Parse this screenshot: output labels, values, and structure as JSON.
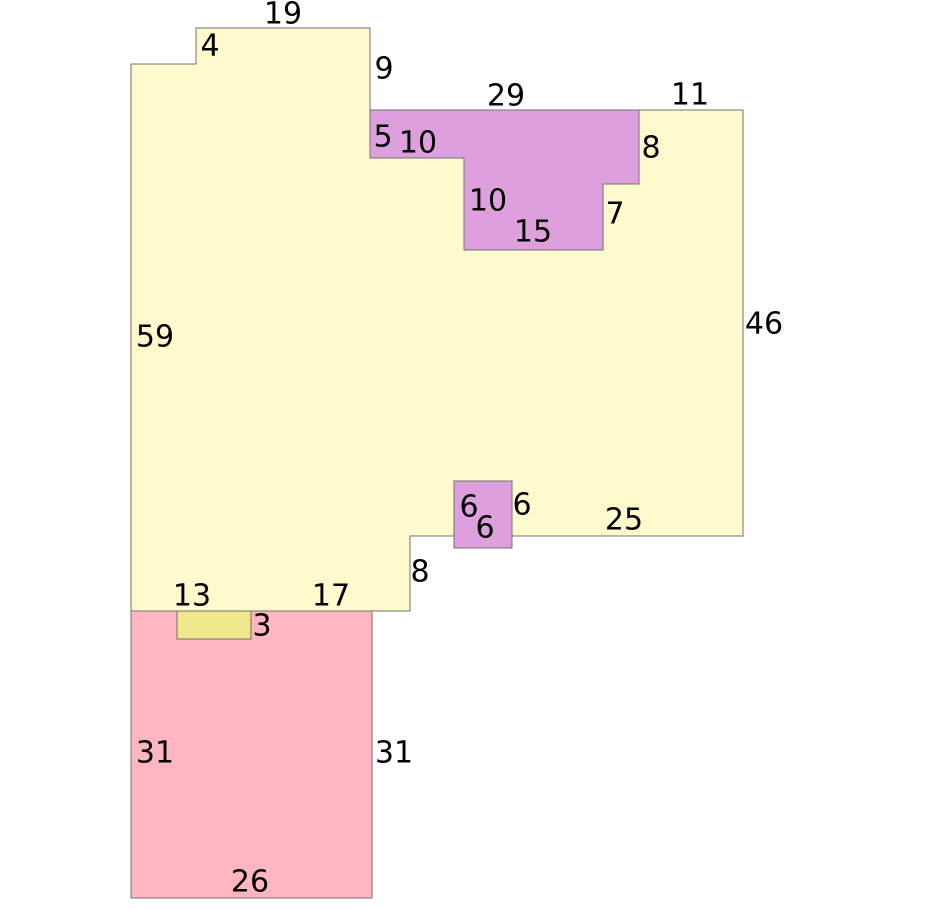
{
  "figure": {
    "background": "#ffffff",
    "stroke_color": "#707070",
    "label_color": "#000000",
    "shapes": [
      {
        "name": "main-yellow-polygon",
        "fill": "#FFFACD",
        "points": [
          [
            131,
            64
          ],
          [
            196,
            64
          ],
          [
            196,
            28
          ],
          [
            370,
            28
          ],
          [
            370,
            110
          ],
          [
            743,
            110
          ],
          [
            743,
            536
          ],
          [
            410,
            536
          ],
          [
            410,
            611
          ],
          [
            131,
            611
          ]
        ]
      },
      {
        "name": "pink-rectangle",
        "fill": "#FFB6C1",
        "points": [
          [
            131,
            611
          ],
          [
            372,
            611
          ],
          [
            372,
            898
          ],
          [
            131,
            898
          ]
        ]
      },
      {
        "name": "khaki-rectangle",
        "fill": "#F0E68C",
        "points": [
          [
            177,
            611
          ],
          [
            251,
            611
          ],
          [
            251,
            639
          ],
          [
            177,
            639
          ]
        ]
      },
      {
        "name": "purple-t-polygon",
        "fill": "#DDA0DD",
        "points": [
          [
            370,
            110
          ],
          [
            639,
            110
          ],
          [
            639,
            184
          ],
          [
            603,
            184
          ],
          [
            603,
            250
          ],
          [
            464,
            250
          ],
          [
            464,
            158
          ],
          [
            370,
            158
          ]
        ]
      },
      {
        "name": "purple-square",
        "fill": "#DDA0DD",
        "points": [
          [
            454,
            481
          ],
          [
            512,
            481
          ],
          [
            512,
            548
          ],
          [
            454,
            548
          ]
        ]
      }
    ],
    "labels": [
      {
        "text": "19",
        "x": 283,
        "y": 14
      },
      {
        "text": "4",
        "x": 210,
        "y": 46
      },
      {
        "text": "9",
        "x": 384,
        "y": 69
      },
      {
        "text": "29",
        "x": 506,
        "y": 96
      },
      {
        "text": "11",
        "x": 690,
        "y": 95
      },
      {
        "text": "5",
        "x": 383,
        "y": 137
      },
      {
        "text": "10",
        "x": 418,
        "y": 143
      },
      {
        "text": "8",
        "x": 651,
        "y": 148
      },
      {
        "text": "10",
        "x": 488,
        "y": 201
      },
      {
        "text": "7",
        "x": 615,
        "y": 214
      },
      {
        "text": "15",
        "x": 533,
        "y": 232
      },
      {
        "text": "59",
        "x": 155,
        "y": 337
      },
      {
        "text": "46",
        "x": 764,
        "y": 324
      },
      {
        "text": "6",
        "x": 469,
        "y": 507
      },
      {
        "text": "6",
        "x": 522,
        "y": 505
      },
      {
        "text": "6",
        "x": 485,
        "y": 528
      },
      {
        "text": "25",
        "x": 624,
        "y": 520
      },
      {
        "text": "8",
        "x": 420,
        "y": 572
      },
      {
        "text": "13",
        "x": 192,
        "y": 596
      },
      {
        "text": "17",
        "x": 331,
        "y": 596
      },
      {
        "text": "3",
        "x": 262,
        "y": 626
      },
      {
        "text": "31",
        "x": 155,
        "y": 753
      },
      {
        "text": "31",
        "x": 394,
        "y": 753
      },
      {
        "text": "26",
        "x": 250,
        "y": 882
      }
    ]
  }
}
